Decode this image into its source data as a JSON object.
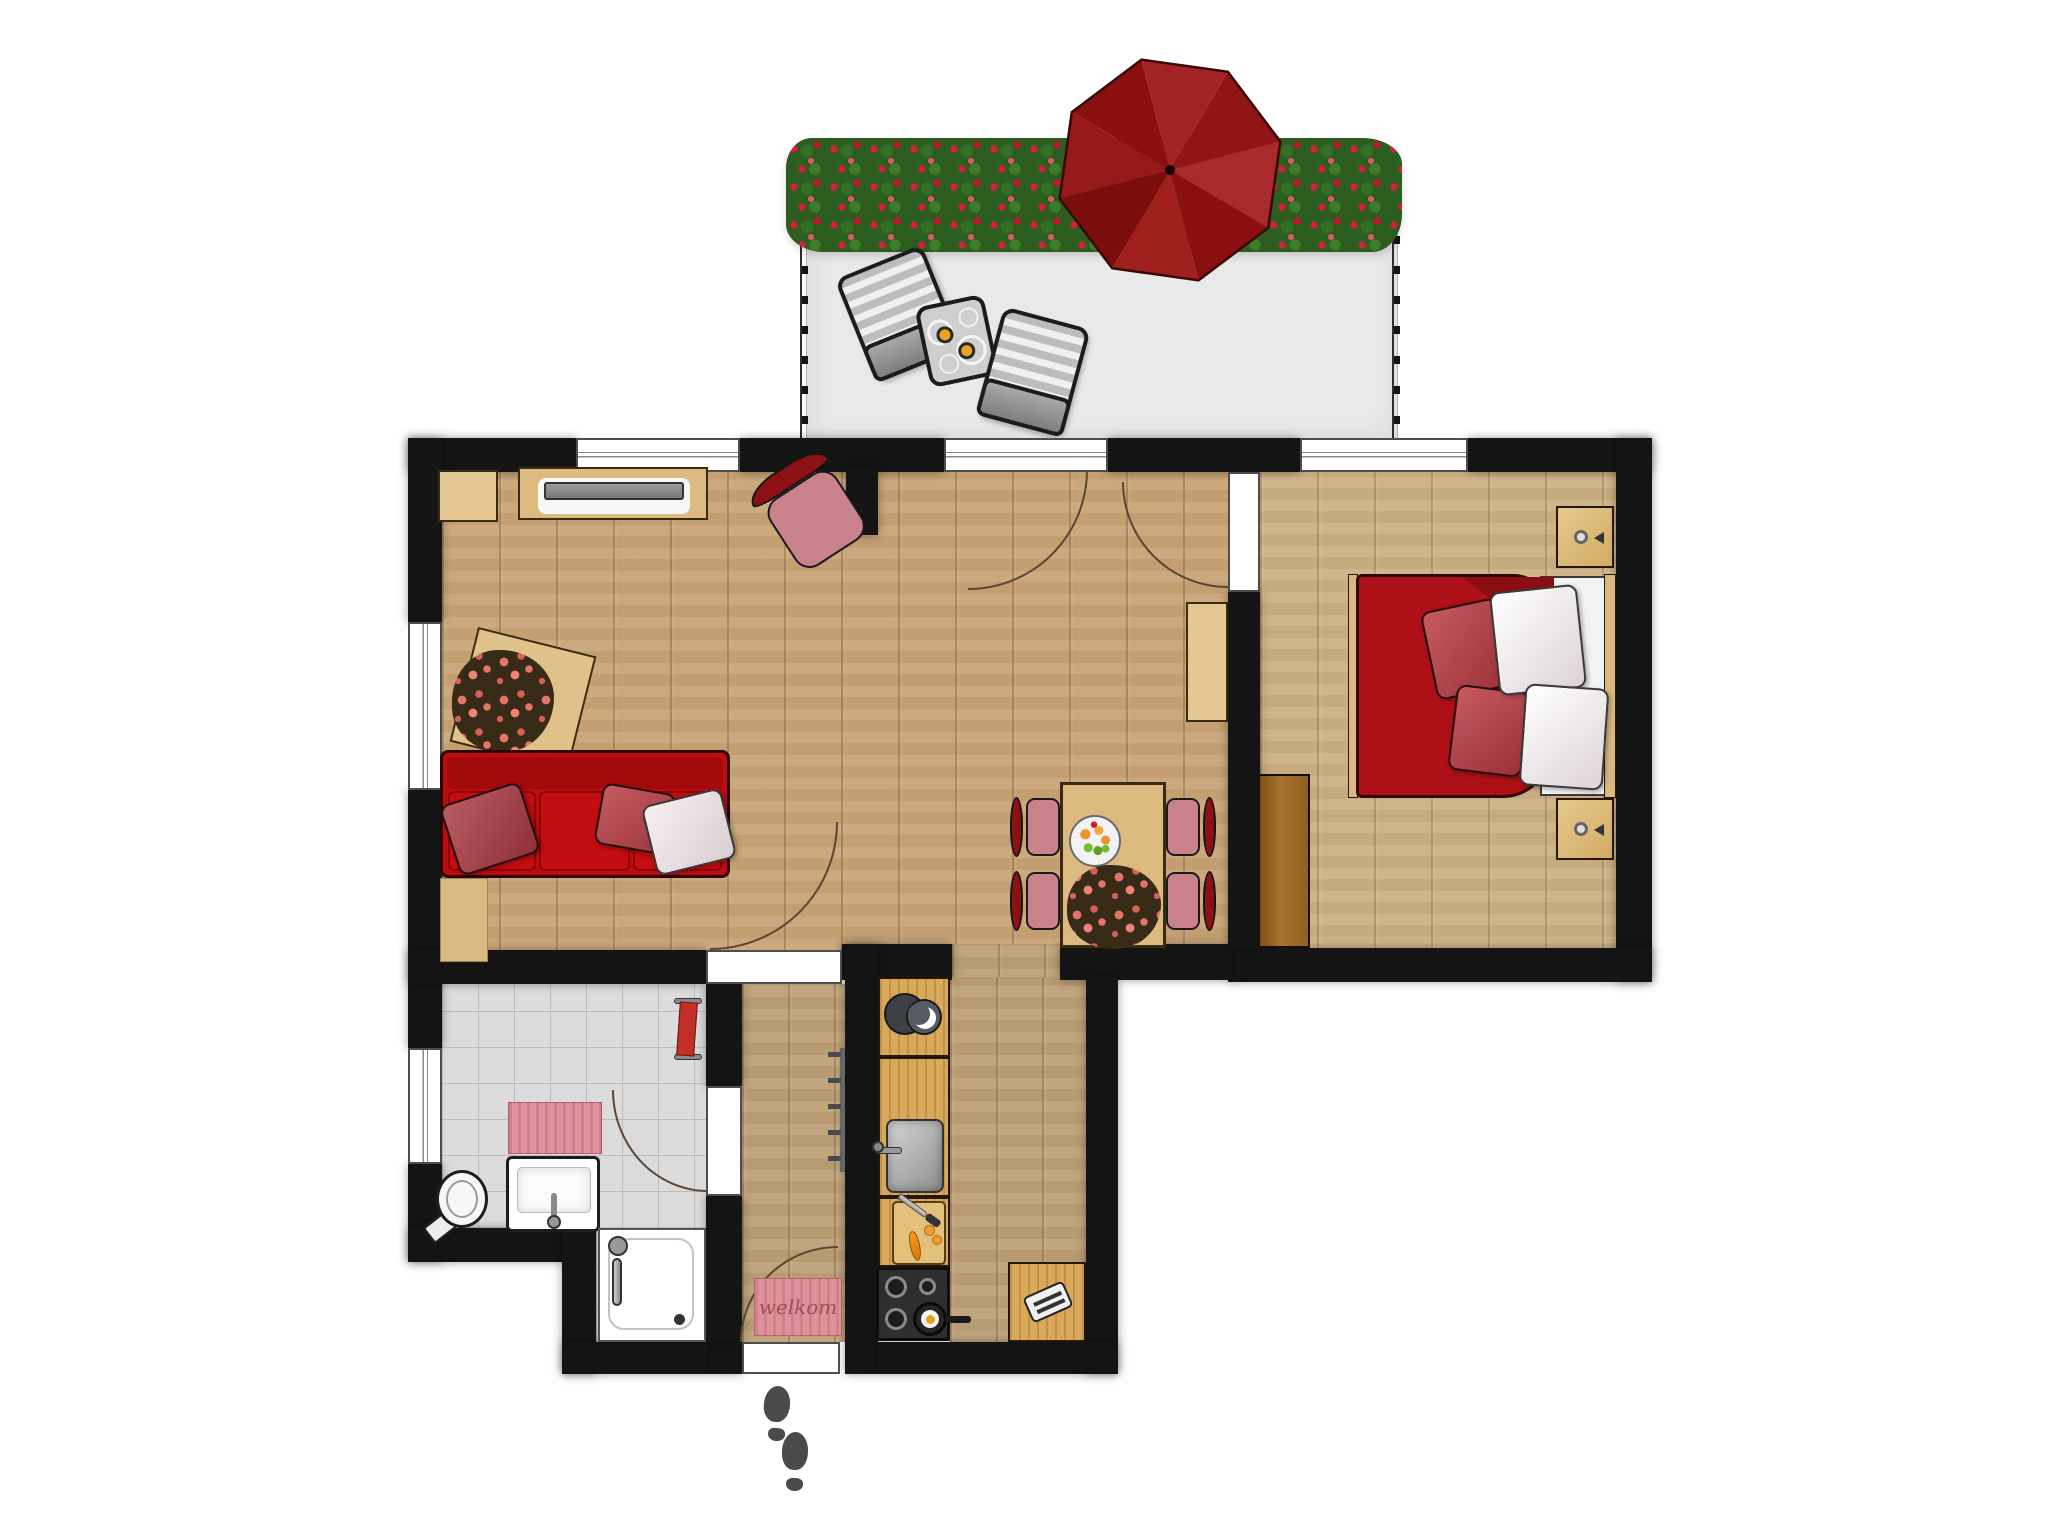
{
  "door_mat": {
    "text": "welkom"
  },
  "colors": {
    "wall": "#141414",
    "wood_main": "#c9a477",
    "wood_hall": "#bda077",
    "wood_bedroom": "#cdb185",
    "tile": "#dcdcdc",
    "balcony_floor": "#e9e9e9",
    "hedge_green": "#2d5c1f",
    "rose_red": "#d61f3e",
    "flower_coral": "#e4746a",
    "sofa_red": "#bf0b0e",
    "bed_red": "#ad1016",
    "chair_pink": "#c9828c",
    "chair_back": "#8c1014",
    "umbrella_red": "#8e1414",
    "counter_wood": "#d9a95b",
    "furniture_wood": "#dcba80",
    "wardrobe_brown": "#a9752e",
    "mat_pink": "#dd939c",
    "towel_red": "#c03028"
  }
}
